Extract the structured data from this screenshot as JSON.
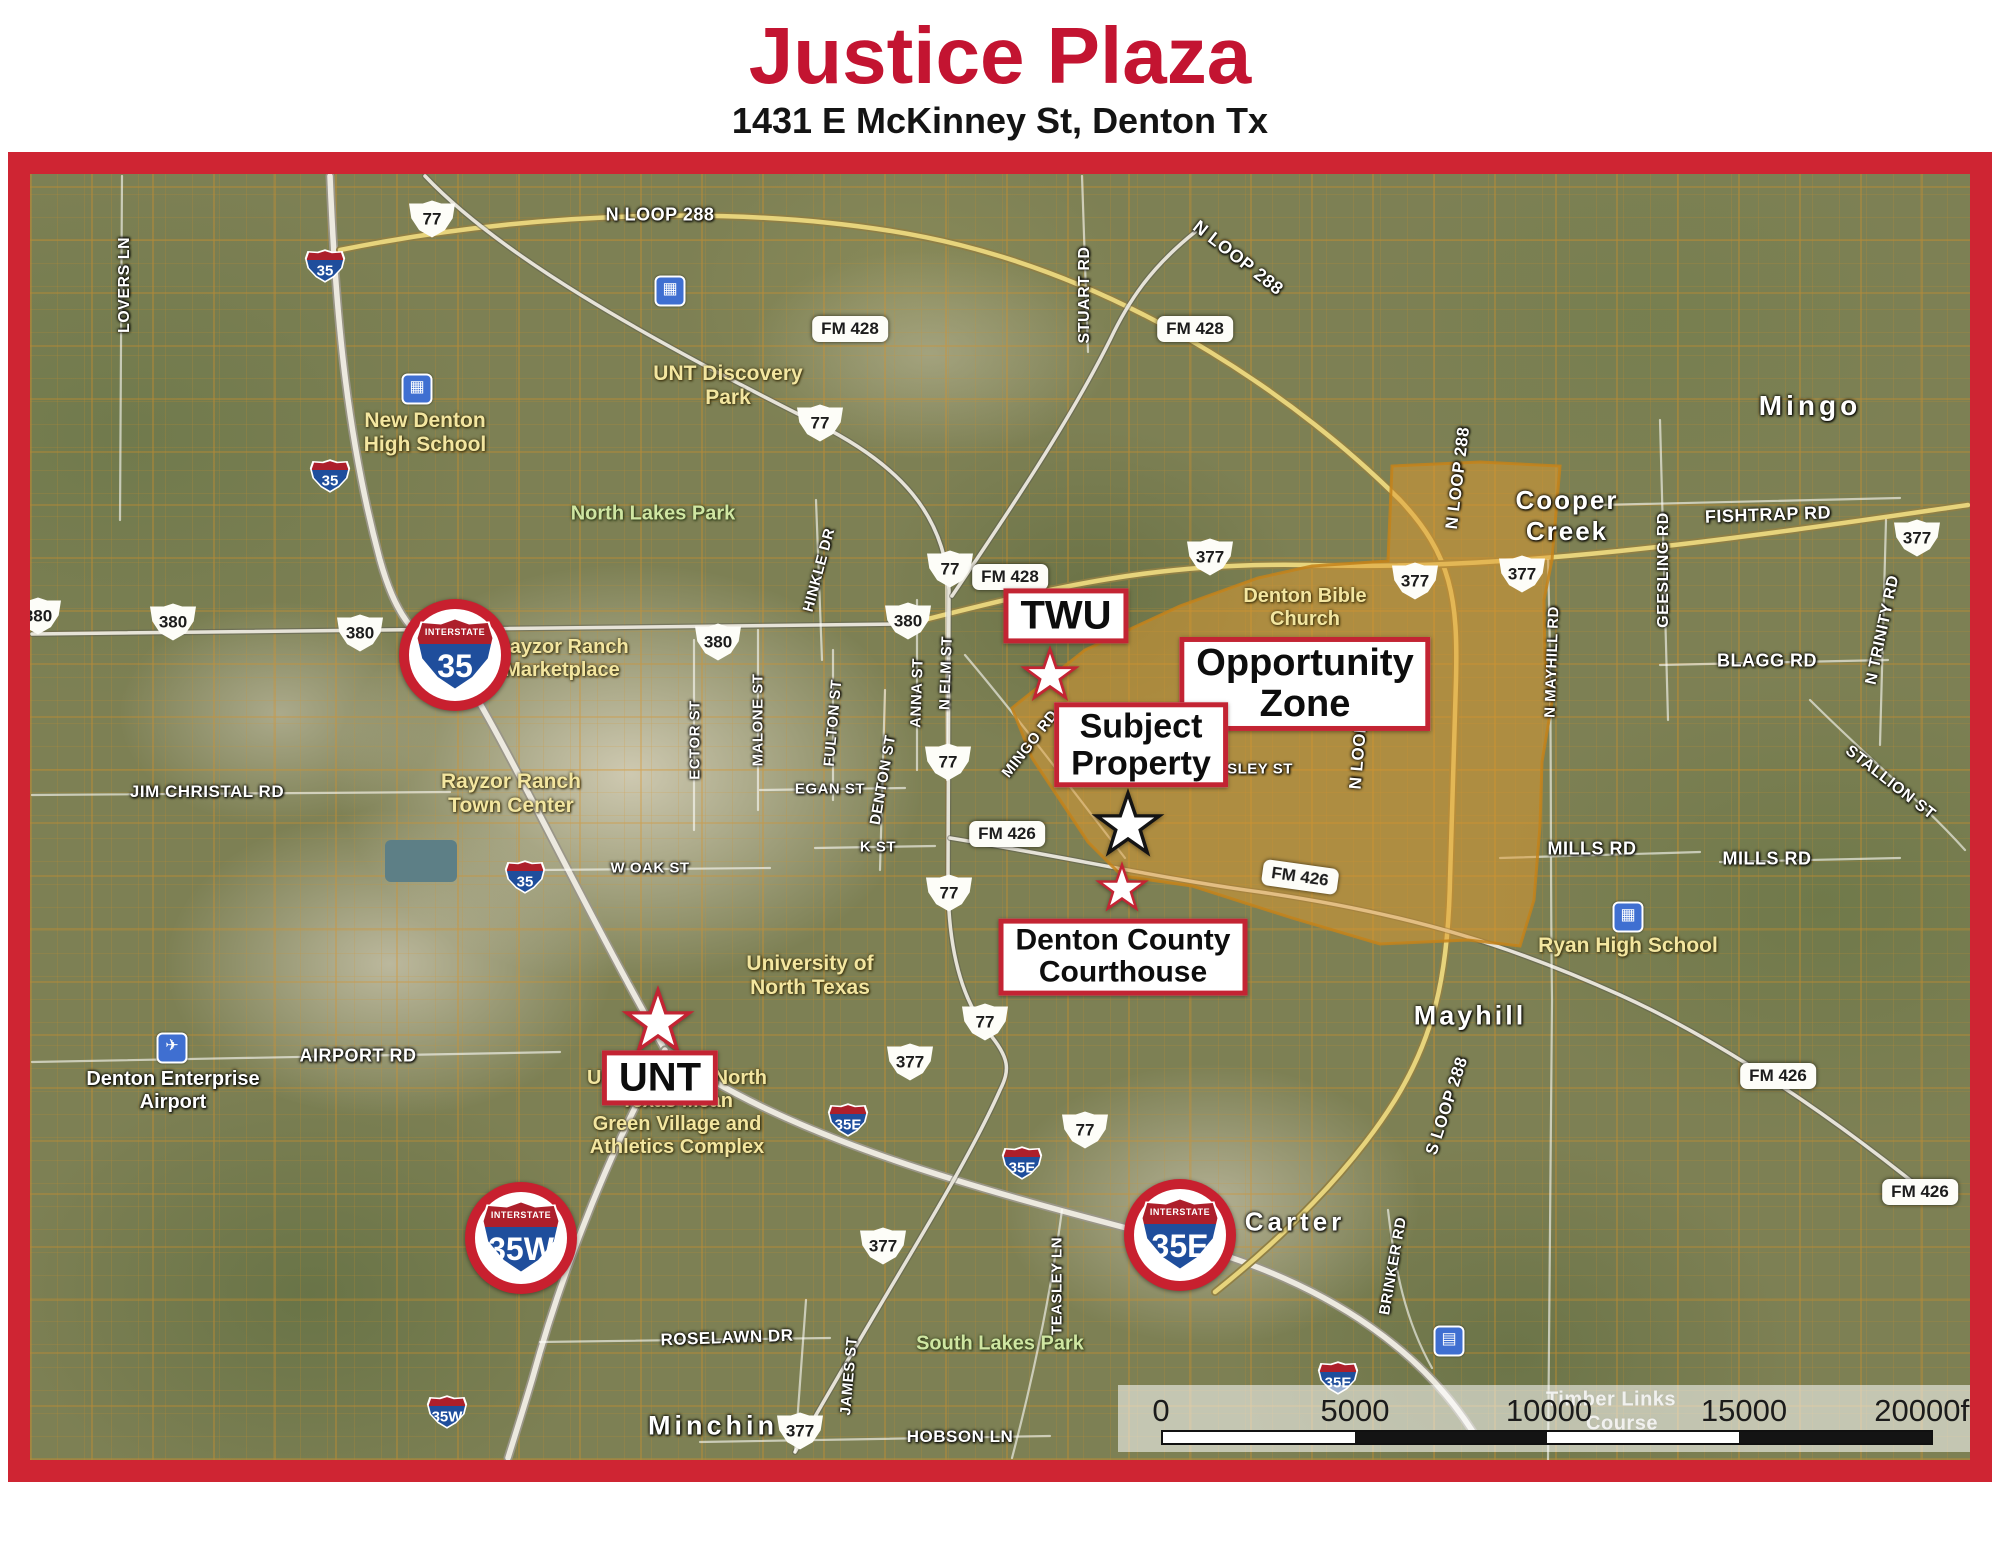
{
  "header": {
    "title": "Justice Plaza",
    "subtitle": "1431 E McKinney St, Denton Tx",
    "title_color": "#c31431"
  },
  "colors": {
    "frame_red": "#cf2533",
    "callout_red": "#c32433",
    "zone_orange": "#e0992e",
    "interstate_blue": "#1f4e9c",
    "interstate_red": "#ad1f2b",
    "poi_yellow": "#f3e6a0",
    "park_green": "#cfe6a2"
  },
  "map": {
    "callouts": [
      {
        "id": "twu",
        "lines": [
          "TWU"
        ],
        "x": 1066,
        "y": 616,
        "fs": 40
      },
      {
        "id": "opportunity-zone",
        "lines": [
          "Opportunity",
          "Zone"
        ],
        "x": 1305,
        "y": 684,
        "fs": 38
      },
      {
        "id": "subject-property",
        "lines": [
          "Subject",
          "Property"
        ],
        "x": 1141,
        "y": 745,
        "fs": 34
      },
      {
        "id": "denton-county-courthouse",
        "lines": [
          "Denton County",
          "Courthouse"
        ],
        "x": 1123,
        "y": 957,
        "fs": 30
      },
      {
        "id": "unt",
        "lines": [
          "UNT"
        ],
        "x": 660,
        "y": 1078,
        "fs": 40
      }
    ],
    "stars": [
      {
        "id": "twu-star",
        "x": 1050,
        "y": 676,
        "size": 62,
        "outline": "#c32433"
      },
      {
        "id": "subject-property-star",
        "x": 1128,
        "y": 826,
        "size": 76,
        "outline": "#141414"
      },
      {
        "id": "courthouse-star",
        "x": 1122,
        "y": 889,
        "size": 56,
        "outline": "#c32433"
      },
      {
        "id": "unt-star",
        "x": 658,
        "y": 1023,
        "size": 76,
        "outline": "#c32433"
      }
    ],
    "shields_us": [
      {
        "t": "77",
        "x": 432,
        "y": 219
      },
      {
        "t": "77",
        "x": 820,
        "y": 423
      },
      {
        "t": "77",
        "x": 950,
        "y": 569
      },
      {
        "t": "77",
        "x": 948,
        "y": 762
      },
      {
        "t": "77",
        "x": 949,
        "y": 893
      },
      {
        "t": "77",
        "x": 985,
        "y": 1022
      },
      {
        "t": "77",
        "x": 1085,
        "y": 1130
      },
      {
        "t": "380",
        "x": 38,
        "y": 616
      },
      {
        "t": "380",
        "x": 173,
        "y": 622
      },
      {
        "t": "380",
        "x": 360,
        "y": 633
      },
      {
        "t": "380",
        "x": 718,
        "y": 642
      },
      {
        "t": "380",
        "x": 908,
        "y": 621
      },
      {
        "t": "377",
        "x": 1210,
        "y": 557
      },
      {
        "t": "377",
        "x": 1415,
        "y": 581
      },
      {
        "t": "377",
        "x": 1522,
        "y": 574
      },
      {
        "t": "377",
        "x": 1917,
        "y": 538
      },
      {
        "t": "377",
        "x": 910,
        "y": 1062
      },
      {
        "t": "377",
        "x": 883,
        "y": 1246
      },
      {
        "t": "377",
        "x": 800,
        "y": 1431
      }
    ],
    "shields_fm": [
      {
        "t": "FM 428",
        "x": 850,
        "y": 329
      },
      {
        "t": "FM 428",
        "x": 1195,
        "y": 329
      },
      {
        "t": "FM 428",
        "x": 1010,
        "y": 577
      },
      {
        "t": "FM 426",
        "x": 1007,
        "y": 834
      },
      {
        "t": "FM 426",
        "x": 1300,
        "y": 877,
        "r": 8
      },
      {
        "t": "FM 426",
        "x": 1778,
        "y": 1076
      },
      {
        "t": "FM 426",
        "x": 1920,
        "y": 1192
      }
    ],
    "shields_interstate_small": [
      {
        "t": "35",
        "x": 325,
        "y": 266
      },
      {
        "t": "35",
        "x": 330,
        "y": 476
      },
      {
        "t": "35",
        "x": 525,
        "y": 877
      },
      {
        "t": "35E",
        "x": 848,
        "y": 1120
      },
      {
        "t": "35E",
        "x": 1022,
        "y": 1163
      },
      {
        "t": "35E",
        "x": 1338,
        "y": 1378
      },
      {
        "t": "35W",
        "x": 447,
        "y": 1412
      }
    ],
    "shields_interstate_large": [
      {
        "t": "35",
        "x": 455,
        "y": 655,
        "band": "INTERSTATE"
      },
      {
        "t": "35W",
        "x": 521,
        "y": 1238,
        "band": "INTERSTATE"
      },
      {
        "t": "35E",
        "x": 1180,
        "y": 1235,
        "band": "INTERSTATE"
      }
    ],
    "road_labels": [
      {
        "t": "N LOOP 288",
        "x": 660,
        "y": 215,
        "r": 0,
        "s": 18,
        "c": "white"
      },
      {
        "t": "N LOOP 288",
        "x": 1238,
        "y": 258,
        "r": 38,
        "s": 18,
        "c": "white"
      },
      {
        "t": "N LOOP 288",
        "x": 1458,
        "y": 478,
        "r": -83,
        "s": 17,
        "c": "white"
      },
      {
        "t": "N LOOP 288",
        "x": 1360,
        "y": 738,
        "r": -85,
        "s": 17,
        "c": "white"
      },
      {
        "t": "S LOOP 288",
        "x": 1447,
        "y": 1106,
        "r": -72,
        "s": 17,
        "c": "white"
      },
      {
        "t": "LOVERS LN",
        "x": 125,
        "y": 285,
        "r": -90,
        "s": 16,
        "c": "white"
      },
      {
        "t": "STUART RD",
        "x": 1085,
        "y": 295,
        "r": -90,
        "s": 16,
        "c": "white"
      },
      {
        "t": "FISHTRAP RD",
        "x": 1768,
        "y": 515,
        "r": -2,
        "s": 18,
        "c": "white"
      },
      {
        "t": "GEESLING RD",
        "x": 1664,
        "y": 570,
        "r": -90,
        "s": 16,
        "c": "white"
      },
      {
        "t": "BLAGG RD",
        "x": 1767,
        "y": 661,
        "r": 0,
        "s": 18,
        "c": "white"
      },
      {
        "t": "N TRINITY RD",
        "x": 1883,
        "y": 630,
        "r": -78,
        "s": 16,
        "c": "white"
      },
      {
        "t": "STALLION ST",
        "x": 1890,
        "y": 783,
        "r": 38,
        "s": 16,
        "c": "white"
      },
      {
        "t": "MILLS RD",
        "x": 1592,
        "y": 849,
        "r": 0,
        "s": 18,
        "c": "white"
      },
      {
        "t": "MILLS RD",
        "x": 1767,
        "y": 859,
        "r": 0,
        "s": 18,
        "c": "white"
      },
      {
        "t": "JIM CHRISTAL RD",
        "x": 207,
        "y": 792,
        "r": 0,
        "s": 17,
        "c": "white"
      },
      {
        "t": "AIRPORT RD",
        "x": 358,
        "y": 1056,
        "r": 0,
        "s": 18,
        "c": "white"
      },
      {
        "t": "W OAK ST",
        "x": 650,
        "y": 868,
        "r": 0,
        "s": 15,
        "c": "white"
      },
      {
        "t": "EGAN ST",
        "x": 830,
        "y": 789,
        "r": 0,
        "s": 15,
        "c": "white"
      },
      {
        "t": "K ST",
        "x": 878,
        "y": 847,
        "r": 0,
        "s": 15,
        "c": "white"
      },
      {
        "t": "ECTOR ST",
        "x": 695,
        "y": 740,
        "r": -90,
        "s": 15,
        "c": "white"
      },
      {
        "t": "MALONE ST",
        "x": 758,
        "y": 720,
        "r": -90,
        "s": 15,
        "c": "white"
      },
      {
        "t": "HINKLE DR",
        "x": 819,
        "y": 570,
        "r": -75,
        "s": 15,
        "c": "white"
      },
      {
        "t": "FULTON ST",
        "x": 833,
        "y": 723,
        "r": -85,
        "s": 15,
        "c": "white"
      },
      {
        "t": "ANNA ST",
        "x": 917,
        "y": 693,
        "r": -88,
        "s": 15,
        "c": "white"
      },
      {
        "t": "N ELM ST",
        "x": 946,
        "y": 673,
        "r": -88,
        "s": 15,
        "c": "white"
      },
      {
        "t": "DENTON ST",
        "x": 883,
        "y": 780,
        "r": -80,
        "s": 15,
        "c": "white"
      },
      {
        "t": "MINGO RD",
        "x": 1030,
        "y": 744,
        "r": -52,
        "s": 15,
        "c": "white"
      },
      {
        "t": "AISLEY ST",
        "x": 1252,
        "y": 769,
        "r": 0,
        "s": 15,
        "c": "white"
      },
      {
        "t": "N MAYHILL RD",
        "x": 1552,
        "y": 662,
        "r": -88,
        "s": 15,
        "c": "white"
      },
      {
        "t": "BRINKER RD",
        "x": 1393,
        "y": 1266,
        "r": -80,
        "s": 15,
        "c": "white"
      },
      {
        "t": "TEASLEY LN",
        "x": 1057,
        "y": 1286,
        "r": -90,
        "s": 15,
        "c": "white"
      },
      {
        "t": "ROSELAWN DR",
        "x": 727,
        "y": 1338,
        "r": -2,
        "s": 17,
        "c": "white"
      },
      {
        "t": "HOBSON LN",
        "x": 960,
        "y": 1437,
        "r": 0,
        "s": 17,
        "c": "white"
      },
      {
        "t": "JAMES ST",
        "x": 849,
        "y": 1376,
        "r": -85,
        "s": 15,
        "c": "white"
      },
      {
        "t": "Timber Links",
        "x": 1611,
        "y": 1400,
        "r": 0,
        "s": 20,
        "c": "faint"
      },
      {
        "t": "Course",
        "x": 1622,
        "y": 1424,
        "r": 0,
        "s": 20,
        "c": "faint"
      }
    ],
    "place_labels": [
      {
        "t": "Mingo",
        "x": 1810,
        "y": 406,
        "s": 28,
        "ls": 4
      },
      {
        "t": "Mayhill",
        "x": 1470,
        "y": 1016,
        "s": 27,
        "ls": 3
      },
      {
        "t": "Carter",
        "x": 1295,
        "y": 1222,
        "s": 26,
        "ls": 4
      },
      {
        "t": "Minchin",
        "x": 713,
        "y": 1426,
        "s": 27,
        "ls": 4
      }
    ],
    "poi_labels": [
      {
        "lines": [
          "Cooper",
          "Creek"
        ],
        "x": 1567,
        "y": 516,
        "s": 26,
        "c": "white",
        "ls": 2
      },
      {
        "lines": [
          "UNT Discovery",
          "Park"
        ],
        "x": 728,
        "y": 386,
        "s": 21,
        "c": "yellow"
      },
      {
        "lines": [
          "New Denton",
          "High School"
        ],
        "x": 425,
        "y": 433,
        "s": 21,
        "c": "yellow"
      },
      {
        "lines": [
          "Rayzor Ranch",
          "Marketplace"
        ],
        "x": 562,
        "y": 659,
        "s": 20,
        "c": "yellow"
      },
      {
        "lines": [
          "Rayzor Ranch",
          "Town Center"
        ],
        "x": 511,
        "y": 794,
        "s": 21,
        "c": "yellow"
      },
      {
        "lines": [
          "Denton Bible",
          "Church"
        ],
        "x": 1305,
        "y": 608,
        "s": 20,
        "c": "yellow"
      },
      {
        "lines": [
          "University of",
          "North Texas"
        ],
        "x": 810,
        "y": 976,
        "s": 21,
        "c": "yellow"
      },
      {
        "lines": [
          "University of North",
          "Texas Mean",
          "Green Village and",
          "Athletics Complex"
        ],
        "x": 677,
        "y": 1113,
        "s": 20,
        "c": "yellow"
      },
      {
        "lines": [
          "Ryan High School"
        ],
        "x": 1628,
        "y": 946,
        "s": 21,
        "c": "yellow"
      },
      {
        "lines": [
          "North Lakes Park"
        ],
        "x": 653,
        "y": 514,
        "s": 20,
        "c": "green"
      },
      {
        "lines": [
          "South Lakes Park"
        ],
        "x": 1000,
        "y": 1344,
        "s": 20,
        "c": "green"
      },
      {
        "lines": [
          "Denton Enterprise",
          "Airport"
        ],
        "x": 173,
        "y": 1091,
        "s": 20,
        "c": "white"
      }
    ],
    "icons": [
      {
        "name": "airport-icon",
        "g": "✈",
        "x": 172,
        "y": 1048
      },
      {
        "name": "school-icon",
        "g": "▦",
        "x": 417,
        "y": 389
      },
      {
        "name": "school-icon",
        "g": "▦",
        "x": 1628,
        "y": 917
      },
      {
        "name": "school-icon",
        "g": "▦",
        "x": 670,
        "y": 291
      },
      {
        "name": "rest-area-icon",
        "g": "▤",
        "x": 1449,
        "y": 1341
      }
    ],
    "opportunity_zone": {
      "points": "1012,708 1085,650 1180,606 1258,578 1312,566 1388,561 1392,466 1480,462 1560,466 1552,560 1544,600 1545,660 1552,702 1542,762 1540,826 1534,900 1520,946 1468,940 1380,944 1292,918 1192,886 1122,876 1088,842 1060,800 1032,758",
      "fill": "#e0992e"
    },
    "roads": [
      {
        "d": "M 330,176 C 335,300 345,430 380,560 C 405,650 435,635 465,678 C 515,760 580,900 665,1050",
        "t": "hwy"
      },
      {
        "d": "M 665,1050 C 790,1140 980,1190 1180,1242 C 1340,1285 1430,1360 1478,1440",
        "t": "hwy"
      },
      {
        "d": "M 665,1050 C 615,1140 565,1260 532,1380 C 520,1420 512,1445 508,1458",
        "t": "hwy"
      },
      {
        "d": "M 340,250 C 560,205 800,205 960,245 C 1140,290 1300,400 1400,500 C 1452,555 1458,600 1456,680 L 1450,880 C 1448,980 1432,1040 1395,1100 C 1350,1172 1280,1240 1215,1292",
        "t": "yellow"
      },
      {
        "d": "M 908,624 C 1060,585 1160,562 1310,565 C 1520,572 1760,535 1968,505",
        "t": "yellow"
      },
      {
        "d": "M 425,176 C 500,255 640,335 818,424 C 900,465 945,515 949,590 L 948,880 C 948,950 962,1000 988,1032 C 1010,1058 1010,1070 1000,1090 C 960,1180 880,1300 795,1452",
        "t": "road"
      },
      {
        "d": "M 32,634 L 905,624",
        "t": "road"
      },
      {
        "d": "M 952,596 C 1010,510 1070,420 1110,340 C 1128,302 1150,268 1195,232",
        "t": "road"
      },
      {
        "d": "M 950,838 C 1060,856 1170,880 1260,892 C 1420,915 1520,950 1620,995 C 1720,1040 1830,1115 1925,1192",
        "t": "road"
      },
      {
        "d": "M 1082,176 L 1088,352",
        "t": "minor"
      },
      {
        "d": "M 122,176 L 120,520",
        "t": "minor"
      },
      {
        "d": "M 816,500 L 822,660",
        "t": "minor"
      },
      {
        "d": "M 694,640 L 694,830",
        "t": "minor"
      },
      {
        "d": "M 758,630 L 758,810",
        "t": "minor"
      },
      {
        "d": "M 833,650 L 833,800",
        "t": "minor"
      },
      {
        "d": "M 917,600 L 917,770",
        "t": "minor"
      },
      {
        "d": "M 946,560 L 947,780",
        "t": "minor"
      },
      {
        "d": "M 885,690 L 880,870",
        "t": "minor"
      },
      {
        "d": "M 540,870 L 770,868",
        "t": "minor"
      },
      {
        "d": "M 760,790 L 905,788",
        "t": "minor"
      },
      {
        "d": "M 815,848 L 935,846",
        "t": "minor"
      },
      {
        "d": "M 32,795 L 450,792",
        "t": "minor"
      },
      {
        "d": "M 32,1062 L 560,1052",
        "t": "minor"
      },
      {
        "d": "M 540,1342 L 830,1338",
        "t": "minor"
      },
      {
        "d": "M 700,1442 L 1050,1436",
        "t": "minor"
      },
      {
        "d": "M 806,1300 L 795,1452",
        "t": "minor"
      },
      {
        "d": "M 1062,1210 C 1050,1300 1030,1390 1012,1458",
        "t": "minor"
      },
      {
        "d": "M 1388,1210 C 1395,1270 1405,1320 1432,1368",
        "t": "minor"
      },
      {
        "d": "M 965,655 C 1020,720 1080,800 1125,858",
        "t": "minor"
      },
      {
        "d": "M 1600,505 L 1900,498",
        "t": "minor"
      },
      {
        "d": "M 1660,665 L 1888,660",
        "t": "minor"
      },
      {
        "d": "M 1660,420 L 1668,720",
        "t": "minor"
      },
      {
        "d": "M 1886,520 L 1880,745",
        "t": "minor"
      },
      {
        "d": "M 1810,700 C 1870,760 1920,800 1965,850",
        "t": "minor"
      },
      {
        "d": "M 1500,858 L 1700,852",
        "t": "minor"
      },
      {
        "d": "M 1720,862 L 1900,858",
        "t": "minor"
      },
      {
        "d": "M 1548,560 C 1552,700 1550,850 1552,1000 L 1548,1460",
        "t": "minor"
      }
    ],
    "scale_bar": {
      "overlay": {
        "x": 1118,
        "y": 1385,
        "w": 852,
        "h": 67
      },
      "ticks": [
        {
          "t": "0",
          "x": 1161
        },
        {
          "t": "5000",
          "x": 1355
        },
        {
          "t": "10000",
          "x": 1549
        },
        {
          "t": "15000",
          "x": 1744
        },
        {
          "t": "20000ft",
          "x": 1926
        }
      ],
      "bar": {
        "x1": 1161,
        "x2": 1933,
        "y": 1430,
        "h": 15
      },
      "segment_colors": [
        "#ffffff",
        "#141414",
        "#ffffff",
        "#141414"
      ]
    }
  }
}
